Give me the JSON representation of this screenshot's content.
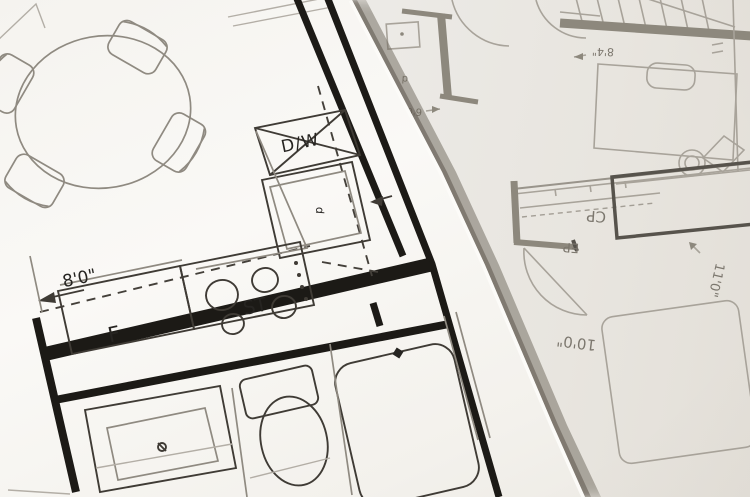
{
  "top_sheet": {
    "labels": {
      "dishwasher": "D/W",
      "stove": "ST",
      "fridge": "F",
      "sink_note": "d",
      "dim_kitchen": "8'0\""
    }
  },
  "lower_sheet": {
    "labels": {
      "closet_cp": "CP",
      "closet_ep": "EP",
      "dim_closet": "11'0\"",
      "dim_room": "10'0\"",
      "dim_hall": "6'0\"",
      "dim_stairs": "8'4\"",
      "door_note": "d"
    }
  },
  "colors": {
    "top_paper": "#f8f6f2",
    "lower_paper": "#eae7e2",
    "ink_bold": "#1c1a16",
    "ink_medium": "#3f3b35",
    "ink_light": "#8f8a81",
    "gray_wall": "#8d887d",
    "gray_line": "#a8a39a",
    "gray_text": "#7c776e",
    "edge_shadow": "#6c655a"
  }
}
